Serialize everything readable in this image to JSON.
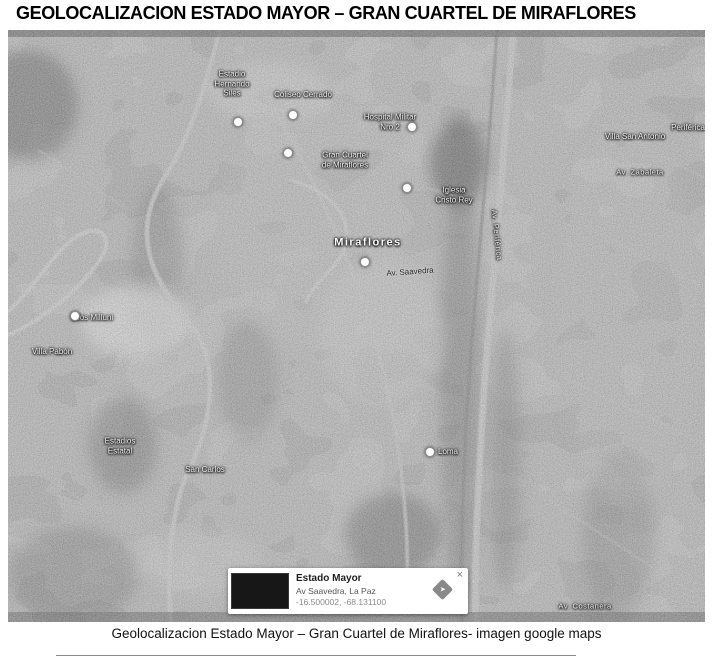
{
  "page": {
    "title": "GEOLOCALIZACION ESTADO MAYOR – GRAN CUARTEL DE MIRAFLORES",
    "caption": "Geolocalizacion Estado Mayor – Gran Cuartel de Miraflores-  imagen google maps"
  },
  "map": {
    "type": "satellite-grayscale",
    "area_shown": "Miraflores, La Paz",
    "labels": [
      {
        "text": "Estadio\nHernando\nSiles",
        "x": 224,
        "y": 54,
        "style": "poi"
      },
      {
        "text": "Coliseo Cerrado",
        "x": 295,
        "y": 65,
        "style": "poi"
      },
      {
        "text": "Hospital Militar\nNro 2",
        "x": 382,
        "y": 92,
        "style": "poi"
      },
      {
        "text": "Gran Cuartel\nde Miraflores",
        "x": 337,
        "y": 130,
        "style": "poi"
      },
      {
        "text": "Iglesia\nCristo Rey",
        "x": 446,
        "y": 165,
        "style": "poi"
      },
      {
        "text": "Miraflores",
        "x": 360,
        "y": 213,
        "style": "area"
      },
      {
        "text": "Av. Saavedra",
        "x": 402,
        "y": 242,
        "style": "dark",
        "rotate": -4
      },
      {
        "text": "Silos Milluni",
        "x": 84,
        "y": 288,
        "style": "poi"
      },
      {
        "text": "Villa Pabón",
        "x": 44,
        "y": 322,
        "style": "poi"
      },
      {
        "text": "Estadios\nEstatal",
        "x": 112,
        "y": 416,
        "style": "poi"
      },
      {
        "text": "San Carlos",
        "x": 197,
        "y": 440,
        "style": "poi"
      },
      {
        "text": "Loma",
        "x": 440,
        "y": 422,
        "style": "poi"
      },
      {
        "text": "Villa San Antonio",
        "x": 627,
        "y": 107,
        "style": "poi"
      },
      {
        "text": "Av. Zabaleta",
        "x": 632,
        "y": 142,
        "style": "road"
      },
      {
        "text": "Periférica",
        "x": 680,
        "y": 98,
        "style": "poi"
      },
      {
        "text": "Av. Costanera",
        "x": 577,
        "y": 576,
        "style": "road"
      },
      {
        "text": "Av. Periférica",
        "x": 489,
        "y": 205,
        "style": "road",
        "rotate": 84
      }
    ],
    "markers": [
      {
        "x": 230,
        "y": 92
      },
      {
        "x": 285,
        "y": 85
      },
      {
        "x": 404,
        "y": 97
      },
      {
        "x": 280,
        "y": 123
      },
      {
        "x": 399,
        "y": 158
      },
      {
        "x": 357,
        "y": 232
      },
      {
        "x": 422,
        "y": 422
      },
      {
        "x": 67,
        "y": 286
      }
    ]
  },
  "info_card": {
    "title": "Estado Mayor",
    "address": "Av Saavedra, La Paz",
    "coordinates": "-16.500002, -68.131100",
    "close_label": "×",
    "directions_icon": "diamond-arrow",
    "arrow_glyph": "➤"
  },
  "colors": {
    "page_bg": "#ffffff",
    "title_text": "#000000",
    "caption_text": "#111111",
    "card_bg": "#ffffff",
    "thumb_bg": "#171717",
    "diamond": "#898989"
  }
}
